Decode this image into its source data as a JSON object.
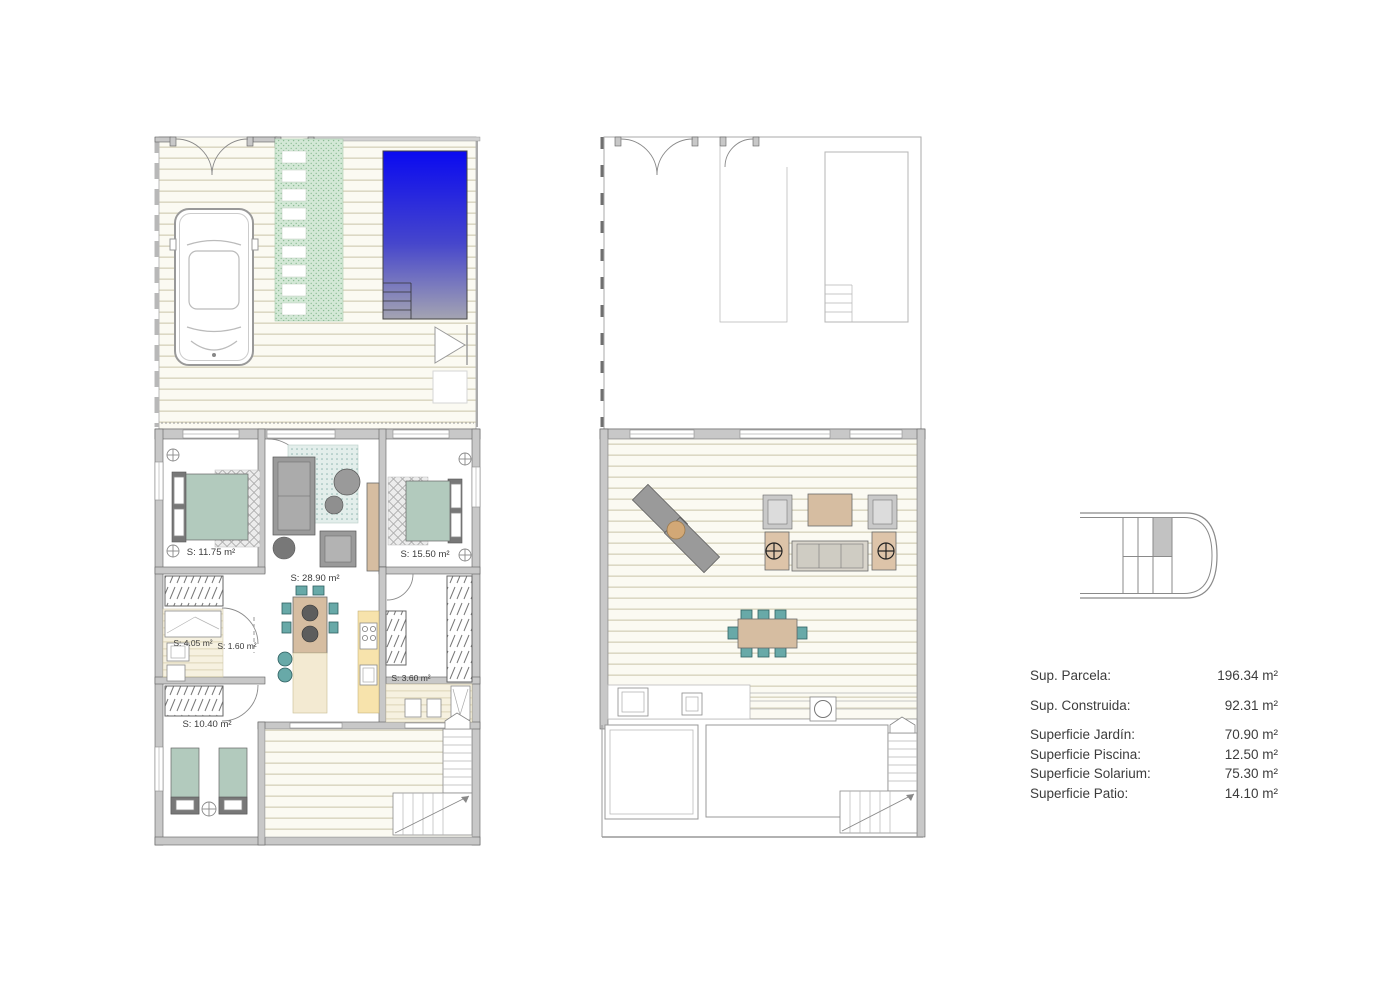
{
  "plans": {
    "ground_floor": {
      "room_labels": [
        {
          "id": "bedroom-1",
          "text": "S: 11.75 m²"
        },
        {
          "id": "living-room",
          "text": "S: 28.90 m²"
        },
        {
          "id": "bedroom-2",
          "text": "S: 15.50 m²"
        },
        {
          "id": "bathroom-1",
          "text": "S: 4.05 m²"
        },
        {
          "id": "hallway",
          "text": "S: 1.60 m²"
        },
        {
          "id": "bathroom-2",
          "text": "S: 3.60 m²"
        },
        {
          "id": "bedroom-3",
          "text": "S: 10.40 m²"
        }
      ]
    },
    "first_floor": {}
  },
  "summary": {
    "rows": [
      {
        "label": "Sup. Parcela:",
        "value": "196.34 m²"
      },
      {
        "label": "Sup. Construida:",
        "value": "92.31 m²"
      },
      {
        "label": "Superficie Jardín:",
        "value": "70.90 m²"
      },
      {
        "label": "Superficie Piscina:",
        "value": "12.50 m²"
      },
      {
        "label": "Superficie Solarium:",
        "value": "75.30 m²"
      },
      {
        "label": "Superficie Patio:",
        "value": "14.10 m²"
      }
    ]
  },
  "colors": {
    "pool_top": "#0a0af0",
    "pool_mid": "#4646cc",
    "pool_bottom": "#a4a4b2",
    "deck_bg": "#fbfaf2",
    "deck_line": "#dcd8c4",
    "lawn": "#d3e8d6",
    "wall": "#c8c8c8",
    "bed": "#b2cabd",
    "wood": "#d6bda1",
    "chair_teal": "#68a9a8",
    "counter_yellow": "#f7e3ac",
    "text": "#3c3c3c"
  }
}
